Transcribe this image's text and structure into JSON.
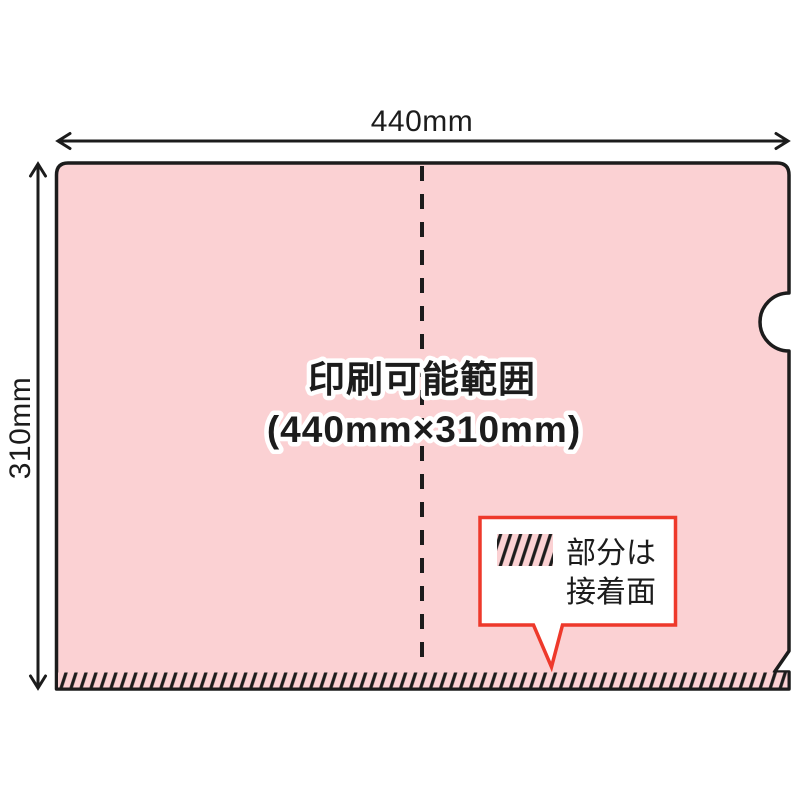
{
  "diagram": {
    "width_label": "440mm",
    "height_label": "310mm",
    "print_area_label": {
      "line1": "印刷可能範囲",
      "line2": "(440mm×310mm)"
    },
    "callout": {
      "swatch_icon": "hatch-swatch",
      "line1": "部分は",
      "line2": "接着面"
    }
  },
  "colors": {
    "folder_fill": "#fbd1d3",
    "outline": "#1c1c1c",
    "callout_border": "#ee392b",
    "label_halo": "#ffffff",
    "paper": "#ffffff"
  }
}
